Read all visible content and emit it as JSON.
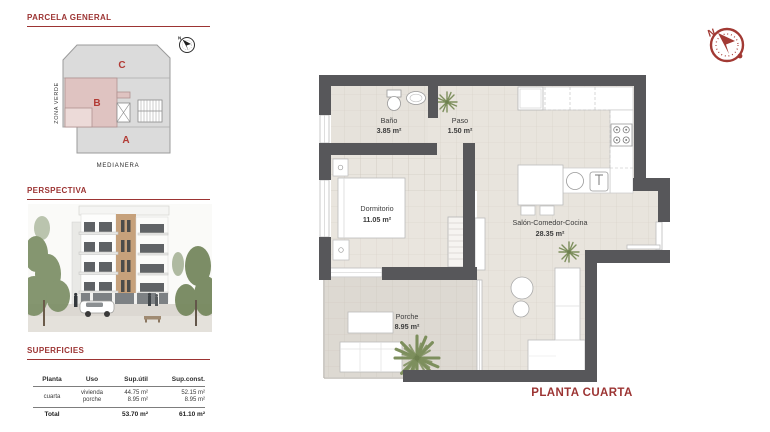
{
  "accent": "#9c3433",
  "sections": {
    "parcela_title": "PARCELA GENERAL",
    "perspectiva_title": "PERSPECTIVA",
    "superficies_title": "SUPERFICIES"
  },
  "siteplan": {
    "block_a": "A",
    "block_b": "B",
    "block_c": "C",
    "zona_verde": "ZONA VERDE",
    "medianera": "MEDIANERA",
    "north": "N"
  },
  "table": {
    "headers": {
      "planta": "Planta",
      "uso": "Uso",
      "sup_util": "Sup.útil",
      "sup_const": "Sup.const."
    },
    "row": {
      "planta": "cuarta",
      "uso1": "vivienda",
      "uso2": "porche",
      "util1": "44.75 m²",
      "util2": "8.95 m²",
      "const1": "52.15 m²",
      "const2": "8.95 m²"
    },
    "total": {
      "label": "Total",
      "util": "53.70 m²",
      "const": "61.10 m²"
    }
  },
  "floorplan": {
    "title": "PLANTA CUARTA",
    "north": "N",
    "rooms": {
      "bano": {
        "name": "Baño",
        "area": "3.85 m²"
      },
      "paso": {
        "name": "Paso",
        "area": "1.50 m²"
      },
      "dormitorio": {
        "name": "Dormitorio",
        "area": "11.05 m²"
      },
      "salon": {
        "name": "Salón-Comedor-Cocina",
        "area": "28.35 m²"
      },
      "porche": {
        "name": "Porche",
        "area": "8.95 m²"
      }
    }
  }
}
